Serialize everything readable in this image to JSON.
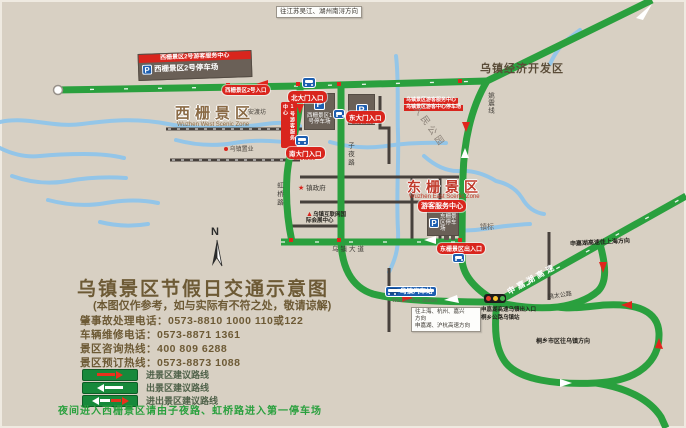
{
  "map": {
    "zones": {
      "west_title": "西栅景区",
      "west_en": "Wuzhen West Scenic Zone",
      "east_title": "东栅景区",
      "east_en": "Wuzhen East Scenic Zone",
      "dev_zone": "乌镇经济开发区",
      "people_park": "人民公园"
    },
    "gates": {
      "north": "北大门入口",
      "east": "东大门入口",
      "south": "南大门入口",
      "entrance_en": "Entrance",
      "east_scenic": "东栅景区出入口"
    },
    "facilities": {
      "parking_icon": "P",
      "west2_center": "西栅景区2号游客服务中心",
      "west2_parking": "西栅景区2号停车场",
      "west2_entry": "西栅景区2号入口",
      "west1_parking": "西栅景区1号停车场",
      "west1_center": "1号游客服务中心",
      "main_center": "乌镇景区游客服务中心",
      "main_center_parking": "乌镇景区游客中心停车场",
      "east_visitor_center": "游客服务中心",
      "east_parking": "东栅景区停车场",
      "bus_station": "乌镇汽车站",
      "bus_station_en": "Wuzhen Bus Station"
    },
    "pois": {
      "town_gov": "镇政府",
      "real_estate": "乌镇置业",
      "expo_center": "乌镇互联网国际会展中心",
      "andu_fang": "安渡坊",
      "town_mark": "镇标",
      "star": "★",
      "triangle": "▲"
    },
    "roads": {
      "ziye": "子夜路",
      "hongqiao": "虹桥路",
      "wuzhen_ave": "乌镇大道",
      "yaozhen": "姚震线",
      "expressway": "申嘉湖高速",
      "yaotai": "姚太公路"
    },
    "directions": {
      "northwest": "往江苏吴江、湖州南浔方向",
      "south_line1": "往上海、杭州、嘉兴",
      "south_line2": "方向",
      "south_line3": "申嘉湖、沪杭高速方向",
      "expressway_exit": "申嘉湖高速乌镇出入口",
      "toll_station": "桐乡公路乌镇站",
      "northeast": "申嘉湖高速往上海方向",
      "tongxiang": "桐乡市区往乌镇方向"
    },
    "compass": "N"
  },
  "info": {
    "title": "乌镇景区节假日交通示意图",
    "subtitle": "(本图仅作参考，如与实际有不符之处，敬请谅解)",
    "hotlines": [
      {
        "label": "肇事故处理电话：",
        "value": "0573-8810 1000  110或122"
      },
      {
        "label": "车辆维修电话：",
        "value": "0573-8871 1361"
      },
      {
        "label": "景区咨询热线：",
        "value": "400 809 6288"
      },
      {
        "label": "景区预订热线：",
        "value": "0573-8873 1088"
      }
    ],
    "night_note": "夜间进入西栅景区请由子夜路、虹桥路进入第一停车场"
  },
  "legend": {
    "items": [
      {
        "label": "进景区建议路线"
      },
      {
        "label": "出景区建议路线"
      },
      {
        "label": "进出景区建议路线"
      }
    ]
  },
  "colors": {
    "route_green": "#2aa03e",
    "alert_red": "#d9251d",
    "water_blue": "#90c5ea",
    "parking_blue": "#1d5eb0"
  }
}
